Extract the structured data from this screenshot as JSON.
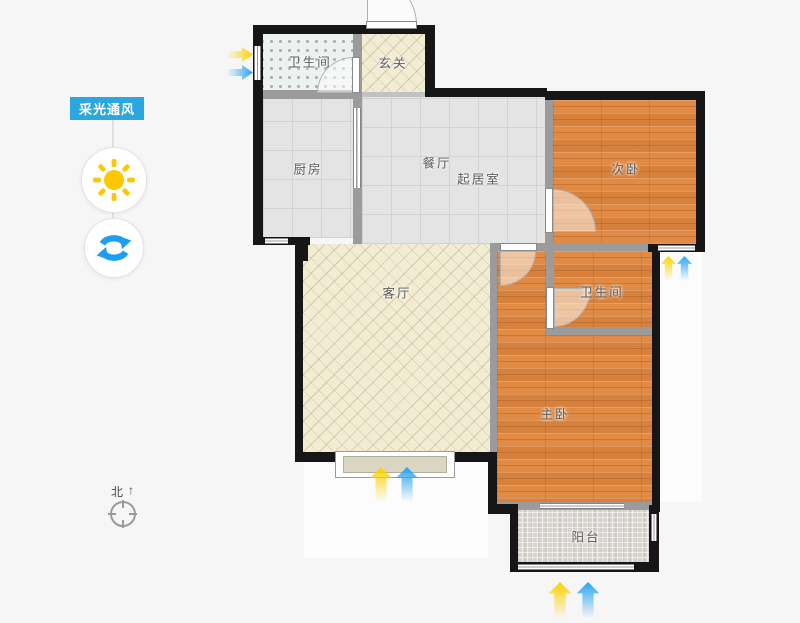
{
  "panel": {
    "toggle_label": "采光通风"
  },
  "rooms": {
    "bath_top": {
      "label": "卫生间"
    },
    "entry": {
      "label": "玄关"
    },
    "kitchen": {
      "label": "厨房"
    },
    "dining": {
      "label": "餐厅"
    },
    "family": {
      "label": "起居室"
    },
    "bedroom2": {
      "label": "次卧"
    },
    "living": {
      "label": "客厅"
    },
    "bath_mid": {
      "label": "卫生间"
    },
    "master": {
      "label": "主卧"
    },
    "balcony": {
      "label": "阳台"
    }
  },
  "compass": {
    "north_label": "北",
    "arrow_glyph": "↑"
  },
  "colors": {
    "accent-blue": "#2aa7e0",
    "sun-yellow": "#fec800",
    "refresh-blue": "#1e9ef0",
    "arrow-yellow": "#ffd100",
    "arrow-blue": "#2aa4f4",
    "wood-floor": "#e08a44",
    "tile-floor": "#e4e4e4",
    "hatch-floor": "#f2ecd4",
    "bath-floor": "#edf1f0",
    "mosaic-floor": "#d7d4cf",
    "wall-exterior": "#161616",
    "wall-interior": "#9b9b9b"
  }
}
